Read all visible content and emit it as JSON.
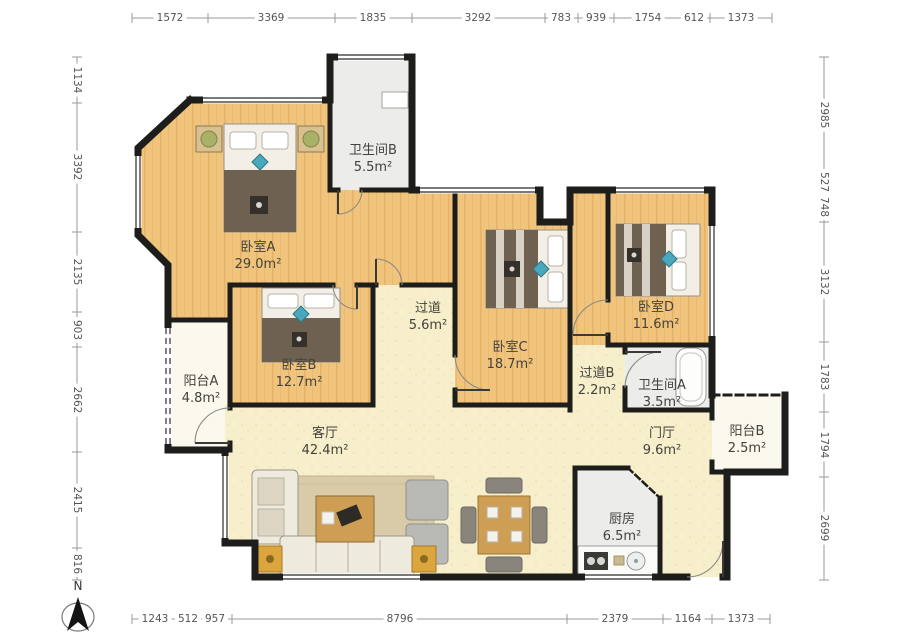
{
  "compass": {
    "label": "N"
  },
  "dimensions": {
    "top": [
      "1572",
      "3369",
      "1835",
      "3292",
      "783",
      "939",
      "1754",
      "612",
      "1373"
    ],
    "left": [
      "1134",
      "3392",
      "2135",
      "903",
      "2662",
      "2415",
      "816"
    ],
    "right": [
      "2985",
      "527",
      "748",
      "3132",
      "1783",
      "1794",
      "2699"
    ],
    "bottom": [
      "1243",
      "512",
      "957",
      "8796",
      "2379",
      "1164",
      "1373"
    ]
  },
  "rooms": {
    "bedroom_a": {
      "name": "卧室A",
      "area": "29.0m²"
    },
    "bathroom_b": {
      "name": "卫生间B",
      "area": "5.5m²"
    },
    "corridor": {
      "name": "过道",
      "area": "5.6m²"
    },
    "bedroom_b": {
      "name": "卧室B",
      "area": "12.7m²"
    },
    "bedroom_c": {
      "name": "卧室C",
      "area": "18.7m²"
    },
    "bedroom_d": {
      "name": "卧室D",
      "area": "11.6m²"
    },
    "balcony_a": {
      "name": "阳台A",
      "area": "4.8m²"
    },
    "corridor_b": {
      "name": "过道B",
      "area": "2.2m²"
    },
    "bathroom_a": {
      "name": "卫生间A",
      "area": "3.5m²"
    },
    "living_room": {
      "name": "客厅",
      "area": "42.4m²"
    },
    "foyer": {
      "name": "门厅",
      "area": "9.6m²"
    },
    "balcony_b": {
      "name": "阳台B",
      "area": "2.5m²"
    },
    "kitchen": {
      "name": "厨房",
      "area": "6.5m²"
    }
  },
  "colors": {
    "wall": "#1d1d1b",
    "wood": "#f1c47d",
    "wood_grain": "#e2ad5f",
    "cream": "#f7efcb",
    "gray_room": "#ececea",
    "balcony": "#fbf8ee",
    "blanket": "#6f6152",
    "accent_teal": "#49a8bc",
    "table_wood": "#cd9e53",
    "dim_text": "#555555",
    "label_text": "#44423c"
  }
}
